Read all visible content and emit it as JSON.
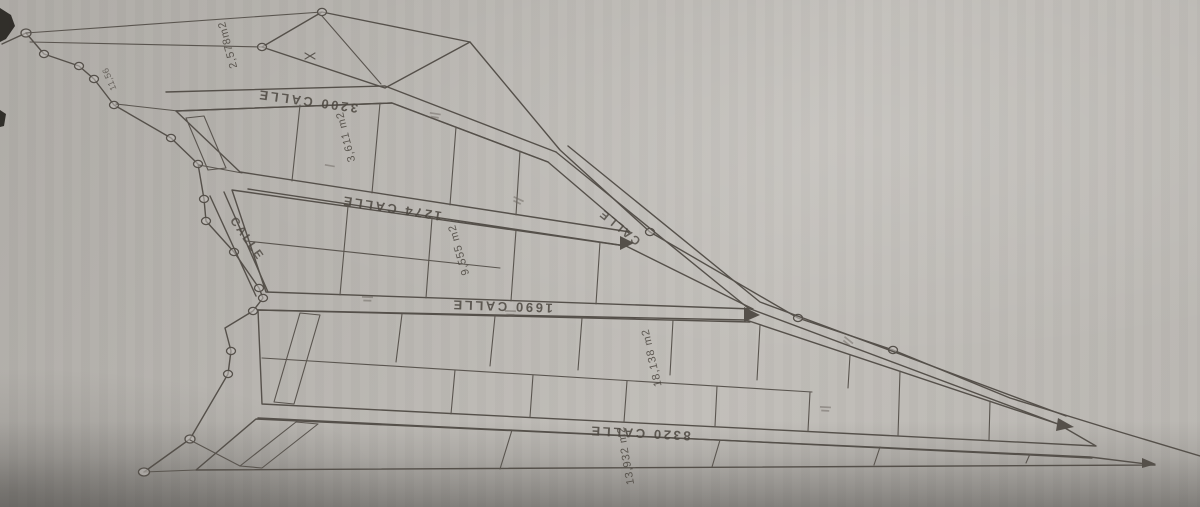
{
  "plan": {
    "streets": [
      {
        "id": "street-3200",
        "label": "3200 CALLE"
      },
      {
        "id": "street-1274",
        "label": "1274 CALLE"
      },
      {
        "id": "street-1690",
        "label": "1690 CALLE"
      },
      {
        "id": "street-8320",
        "label": "8320 CALLE"
      },
      {
        "id": "street-left",
        "label": "CALLE"
      },
      {
        "id": "street-right",
        "label": "CALLE"
      }
    ],
    "parcels": [
      {
        "id": "parcel-a",
        "area": "2,578m2"
      },
      {
        "id": "parcel-b",
        "area": "3,611 m2"
      },
      {
        "id": "parcel-c",
        "area": "9,555 m2"
      },
      {
        "id": "parcel-d",
        "area": "18,138 m2"
      },
      {
        "id": "parcel-e",
        "area": "13,932 m2"
      }
    ],
    "dimensions": [
      {
        "id": "dim-1",
        "label": "11,56"
      }
    ],
    "colors": {
      "paper": "#b7b4af",
      "ink": "#55504a",
      "text": "#4c4740",
      "shadow": "#8a8781"
    }
  }
}
